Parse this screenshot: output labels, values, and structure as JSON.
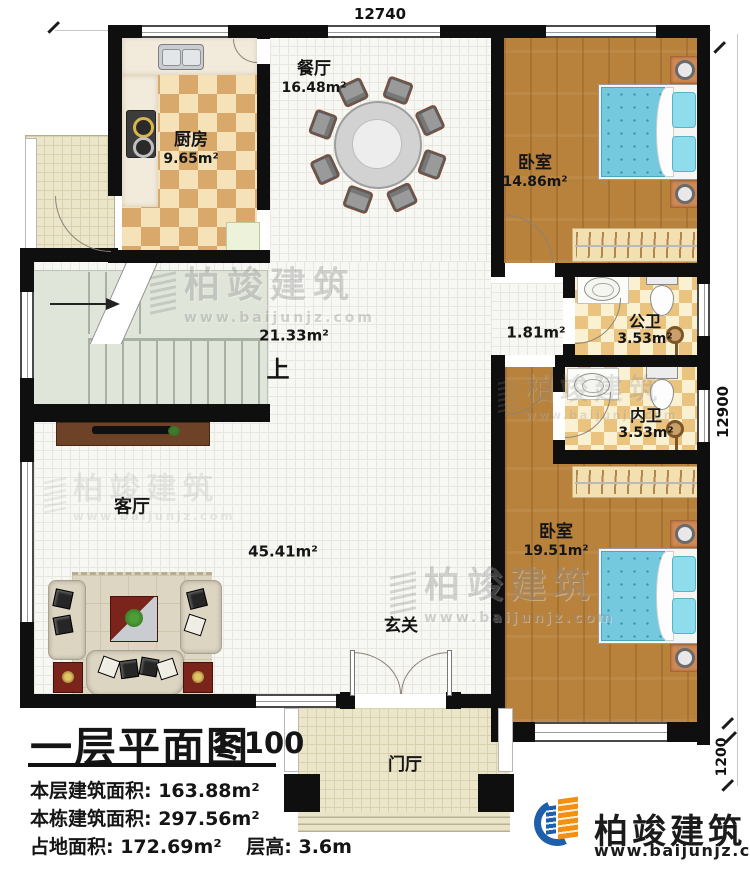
{
  "dimensions": {
    "top": "12740",
    "right": "12900",
    "right_lower": "1200"
  },
  "rooms": {
    "dining": {
      "name": "餐厅",
      "area": "16.48m²"
    },
    "kitchen": {
      "name": "厨房",
      "area": "9.65m²"
    },
    "bedroom_top": {
      "name": "卧室",
      "area": "14.86m²"
    },
    "hall": {
      "area": "21.33m²",
      "up": "上"
    },
    "corridor": {
      "area": "1.81m²"
    },
    "public_bath": {
      "name": "公卫",
      "area": "3.53m²"
    },
    "inner_bath": {
      "name": "内卫",
      "area": "3.53m²"
    },
    "bedroom_bottom": {
      "name": "卧室",
      "area": "19.51m²"
    },
    "living": {
      "name": "客厅",
      "area": "45.41m²"
    },
    "entry": {
      "name": "玄关"
    },
    "foyer": {
      "name": "门厅"
    }
  },
  "title_block": {
    "title": "一层平面图",
    "scale": "1:100",
    "stats": [
      "本层建筑面积: 163.88m²",
      "本栋建筑面积: 297.56m²",
      "占地面积: 172.69m²",
      "层高: 3.6m"
    ]
  },
  "brand": {
    "name": "柏竣建筑",
    "url": "www.baijunjz.com"
  },
  "watermark": {
    "name": "柏竣建筑",
    "url": "www.baijunjz.com"
  }
}
